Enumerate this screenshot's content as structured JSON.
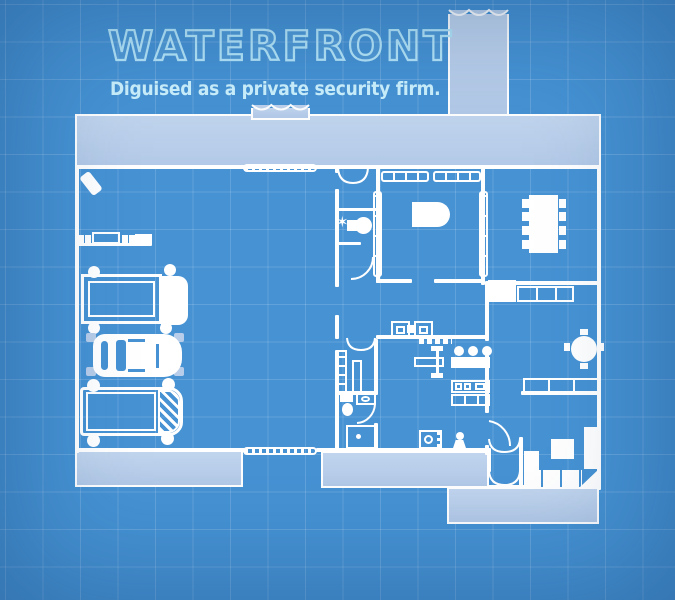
{
  "header": {
    "title": "WATERFRONT",
    "subtitle": "Diguised as a private security firm."
  },
  "palette": {
    "background": "#4692d3",
    "grid_line": "rgba(255,255,255,0.15)",
    "pavement": "#b7cdea",
    "wall": "#ffffff",
    "title_outline": "#b3e5f9",
    "subtitle_color": "#ccf1fd"
  },
  "glyphs": {
    "star": "✶"
  },
  "objects": {
    "exterior": [
      "top-walkway",
      "north-driveway",
      "entrance-stoop",
      "south-west-pad",
      "patio-upper",
      "patio-lower"
    ],
    "garage": [
      "open-door-leaf",
      "workbench",
      "box-truck",
      "sedan",
      "van",
      "garage-door-north",
      "garage-door-south"
    ],
    "entry_hall": [
      "entrance-double-door",
      "fancy-toilet",
      "powder-room-door"
    ],
    "office": [
      "window-wall-north",
      "window-wall-west",
      "window-wall-east",
      "executive-desk"
    ],
    "dining": [
      "dining-table",
      "chairs-x8",
      "sideboard",
      "cabinet-row"
    ],
    "lounge": [
      "round-table",
      "wall-sofa"
    ],
    "living": [
      "sectional-sofa",
      "coffee-table",
      "patio-vestibule-doors"
    ],
    "kitchen": [
      "armchairs",
      "side-table",
      "weight-bench",
      "bar-stools",
      "bar-counter",
      "kitchen-counter",
      "washing-machine",
      "statue"
    ],
    "bathroom": [
      "closet-shelves",
      "closet-cabinet",
      "toilet",
      "vanity",
      "shower"
    ]
  }
}
